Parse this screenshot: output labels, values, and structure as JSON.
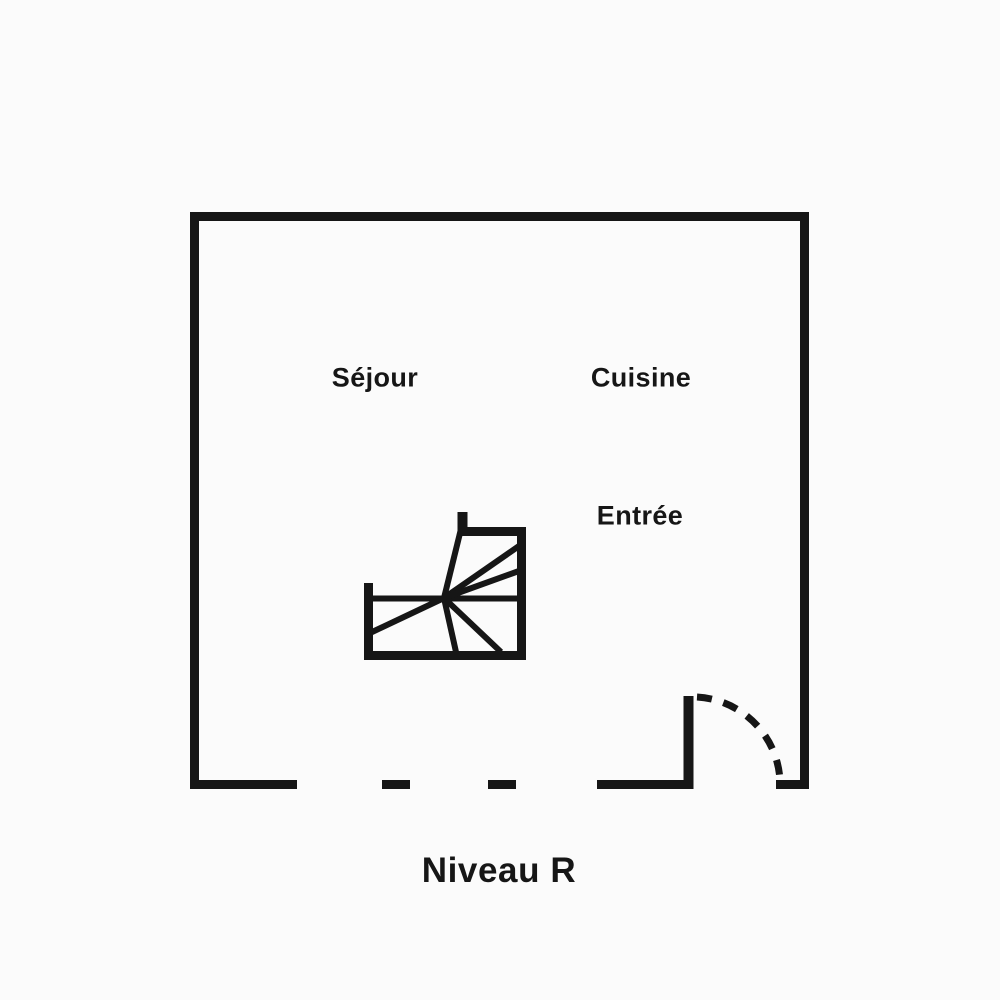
{
  "floor_plan": {
    "caption": "Niveau R",
    "rooms": [
      {
        "id": "sejour",
        "label": "Séjour"
      },
      {
        "id": "cuisine",
        "label": "Cuisine"
      },
      {
        "id": "entree",
        "label": "Entrée"
      }
    ]
  },
  "colors": {
    "ink": "#161616",
    "background": "#fbfbfb"
  }
}
